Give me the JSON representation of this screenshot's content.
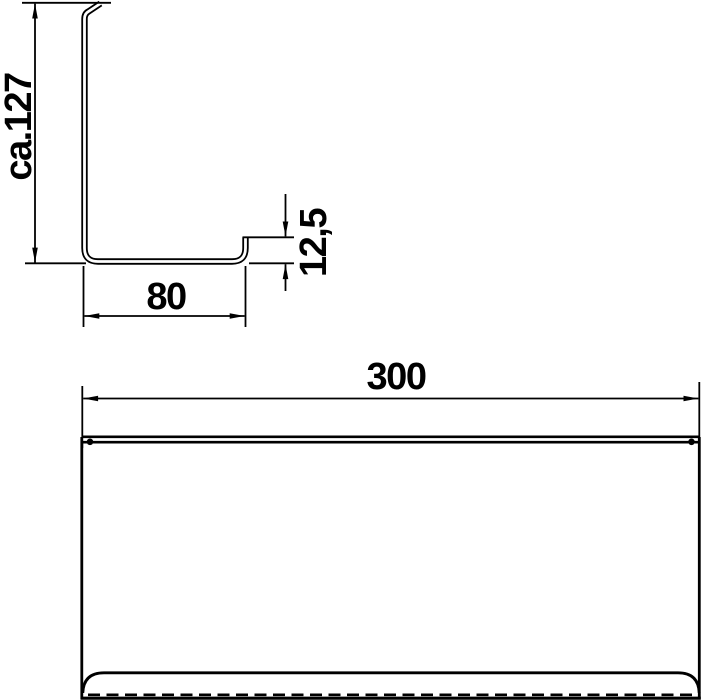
{
  "page": {
    "background_color": "#ffffff",
    "line_color": "#000000",
    "kind": "technical-dimension-drawing"
  },
  "profile_view": {
    "description": "side cross-section of sheet-metal shelf profile with top hook, bottom run and front lip",
    "dim_height": {
      "label": "ca.127",
      "orientation": "vertical"
    },
    "dim_depth": {
      "label": "80",
      "orientation": "horizontal"
    },
    "dim_lip": {
      "label": "12,5",
      "orientation": "vertical"
    }
  },
  "front_view": {
    "description": "front elevation of shelf with rolled bottom lip and hidden edge",
    "dim_width": {
      "label": "300",
      "orientation": "horizontal"
    }
  }
}
